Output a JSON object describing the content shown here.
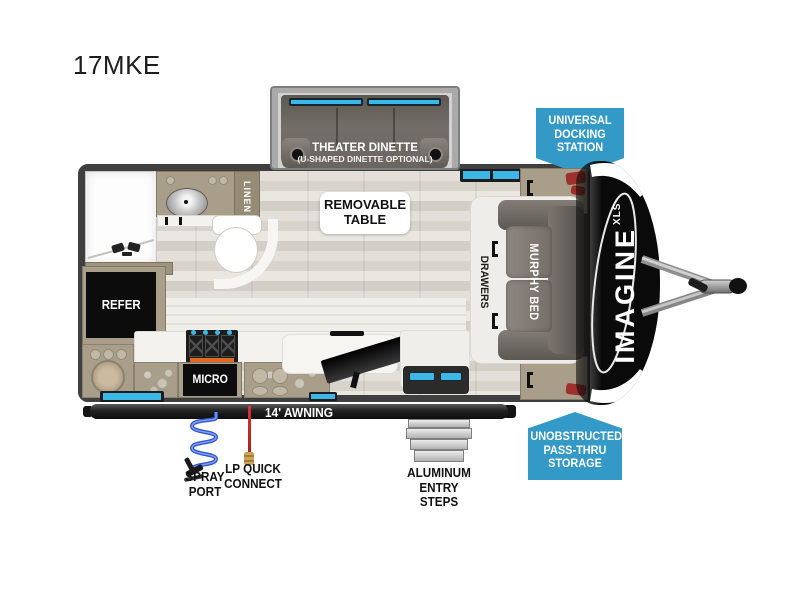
{
  "model": "17MKE",
  "slideout": {
    "title": "THEATER DINETTE",
    "subtitle": "(U-SHAPED DINETTE OPTIONAL)"
  },
  "table_label": {
    "line1": "REMOVABLE",
    "line2": "TABLE"
  },
  "badges": {
    "docking": {
      "line1": "UNIVERSAL",
      "line2": "DOCKING",
      "line3": "STATION"
    },
    "passthru": {
      "line1": "UNOBSTRUCTED",
      "line2": "PASS-THRU",
      "line3": "STORAGE"
    },
    "color": "#3399c6"
  },
  "rooms": {
    "linen": "LINEN",
    "refrigerator": "REFER",
    "microwave": "MICRO",
    "drawers": "DRAWERS",
    "murphy_bed": "MURPHY BED"
  },
  "exterior": {
    "awning": "14' AWNING",
    "spray_port_line1": "SPRAY",
    "spray_port_line2": "PORT",
    "lp_line1": "LP QUICK",
    "lp_line2": "CONNECT",
    "steps_line1": "ALUMINUM",
    "steps_line2": "ENTRY STEPS"
  },
  "branding": {
    "name": "IMAGINE",
    "series": "XLS"
  },
  "colors": {
    "window_cyan": "#3cb8e8",
    "wall": "#3f3f3f",
    "cabinet_tan": "#a89e8a"
  }
}
